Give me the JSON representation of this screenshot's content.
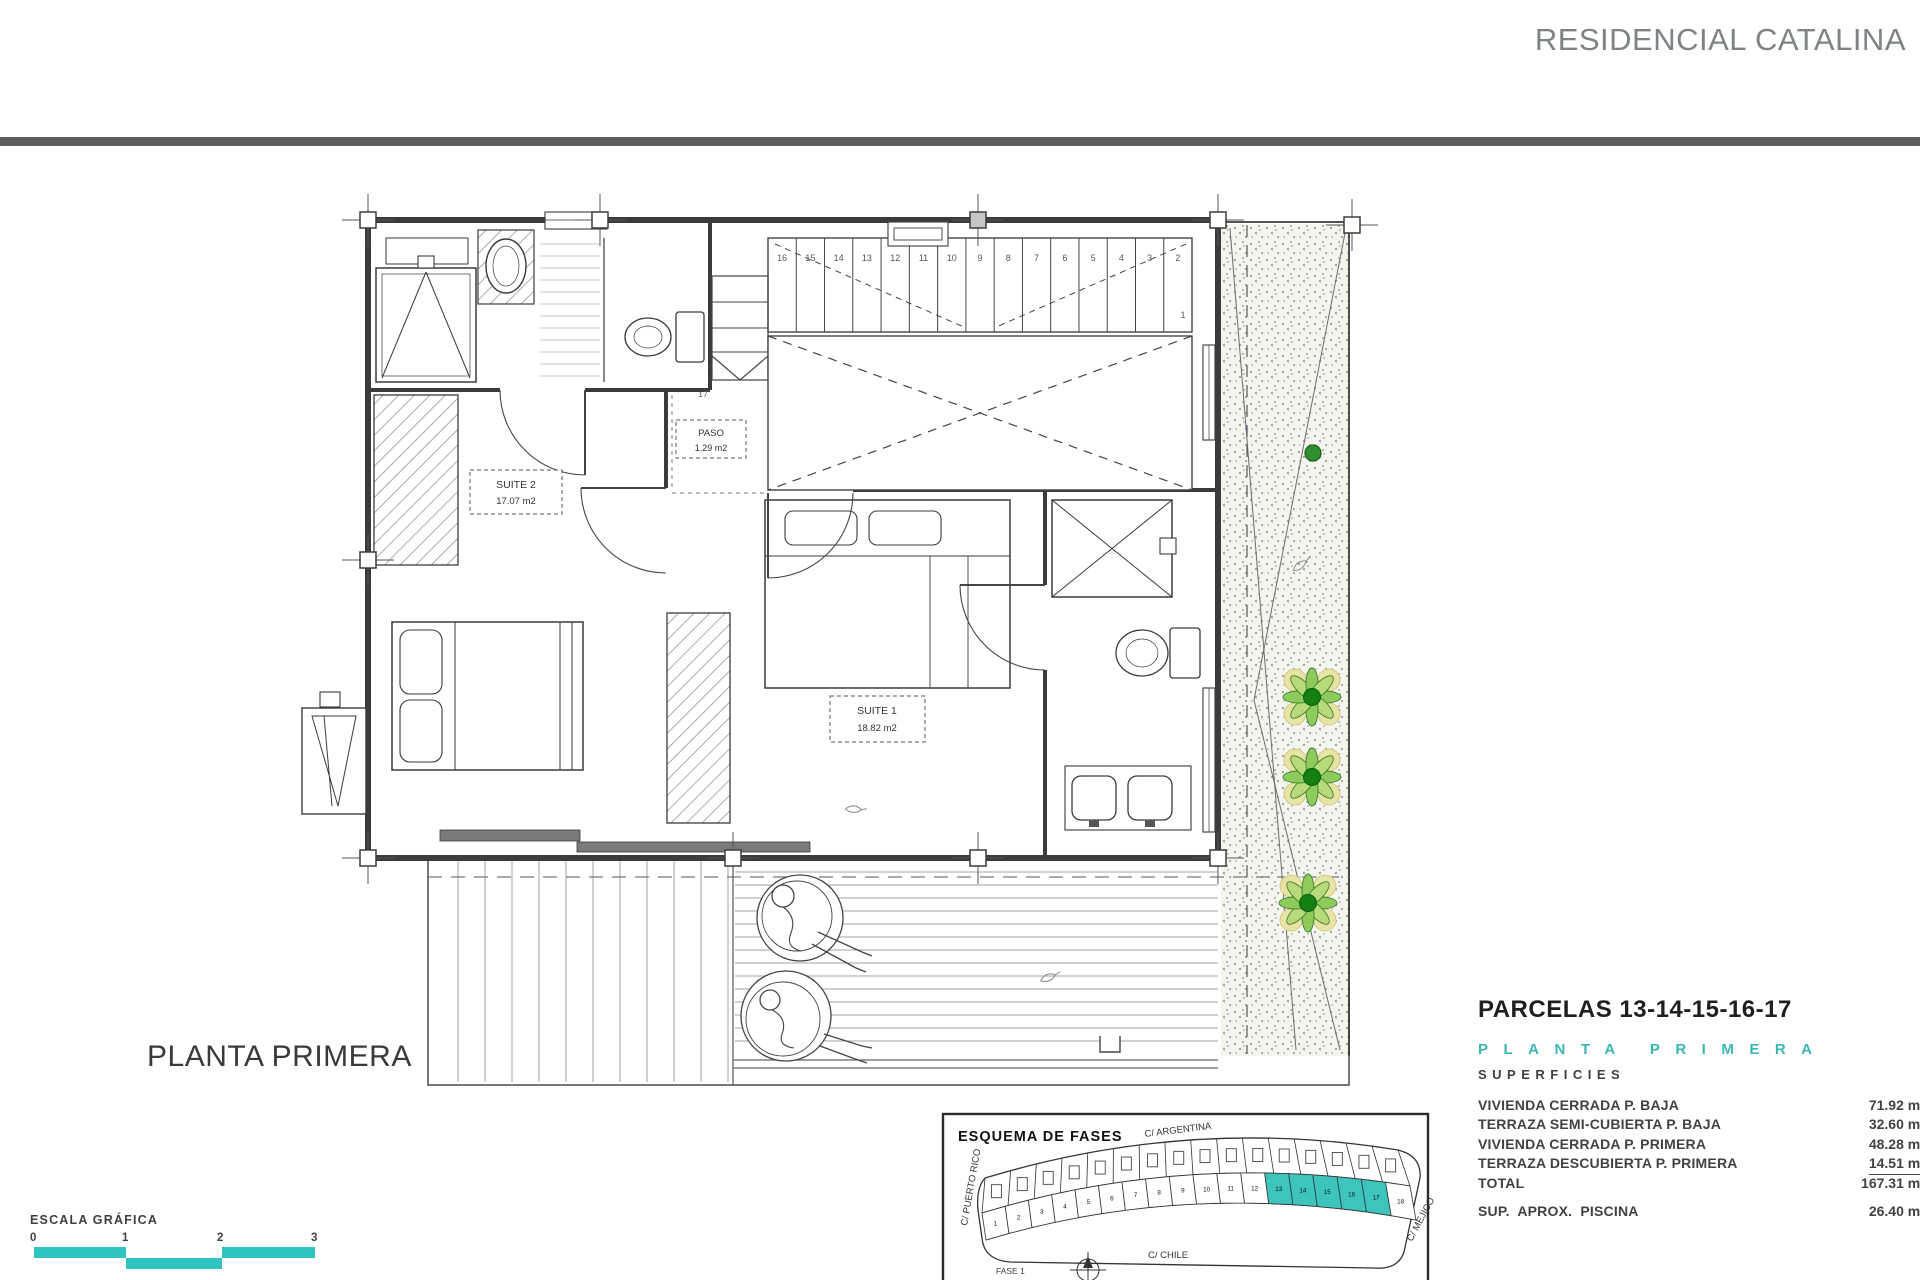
{
  "header": {
    "project_title": "RESIDENCIAL CATALINA"
  },
  "plan": {
    "floor_label": "PLANTA PRIMERA",
    "rooms": {
      "suite2": {
        "name": "SUITE 2",
        "area": "17.07 m2"
      },
      "suite1": {
        "name": "SUITE 1",
        "area": "18.82 m2"
      },
      "paso": {
        "name": "PASO",
        "area": "1.29 m2"
      }
    },
    "stairs": {
      "numbers": [
        "16",
        "15",
        "14",
        "13",
        "12",
        "11",
        "10",
        "9",
        "8",
        "7",
        "6",
        "5",
        "4",
        "3",
        "2"
      ],
      "first": "1",
      "upper": "17"
    }
  },
  "scalebar": {
    "label": "ESCALA GRÁFICA",
    "ticks": [
      "0",
      "1",
      "2",
      "3"
    ],
    "color": "#2fc4c0"
  },
  "summary": {
    "parcels_title": "PARCELAS 13-14-15-16-17",
    "floor_heading": "PLANTA PRIMERA",
    "surfaces_heading": "SUPERFICIES",
    "accent_color": "#3bb7b2",
    "rows": [
      {
        "label": "VIVIENDA CERRADA P. BAJA",
        "value": "71.92 m2"
      },
      {
        "label": "TERRAZA SEMI-CUBIERTA P. BAJA",
        "value": "32.60 m2"
      },
      {
        "label": "VIVIENDA CERRADA P. PRIMERA",
        "value": "48.28 m2"
      },
      {
        "label": "TERRAZA DESCUBIERTA P. PRIMERA",
        "value": "14.51 m2"
      },
      {
        "label": "TOTAL",
        "value": "167.31 m2"
      }
    ],
    "pool_row": {
      "label": "SUP.  APROX.  PISCINA",
      "value": "26.40 m2"
    }
  },
  "inset": {
    "title": "ESQUEMA DE FASES",
    "streets": {
      "top": "C/ ARGENTINA",
      "left": "C/ PUERTO RICO",
      "bottom": "C/ CHILE",
      "right": "C/ MEJICO"
    },
    "phase": "FASE 1",
    "parcels": [
      "1",
      "2",
      "3",
      "4",
      "5",
      "6",
      "7",
      "8",
      "9",
      "10",
      "11",
      "12",
      "13",
      "14",
      "15",
      "16",
      "17",
      "18"
    ],
    "highlighted": [
      "13",
      "14",
      "15",
      "16",
      "17"
    ],
    "highlight_color": "#3cc4bd"
  }
}
